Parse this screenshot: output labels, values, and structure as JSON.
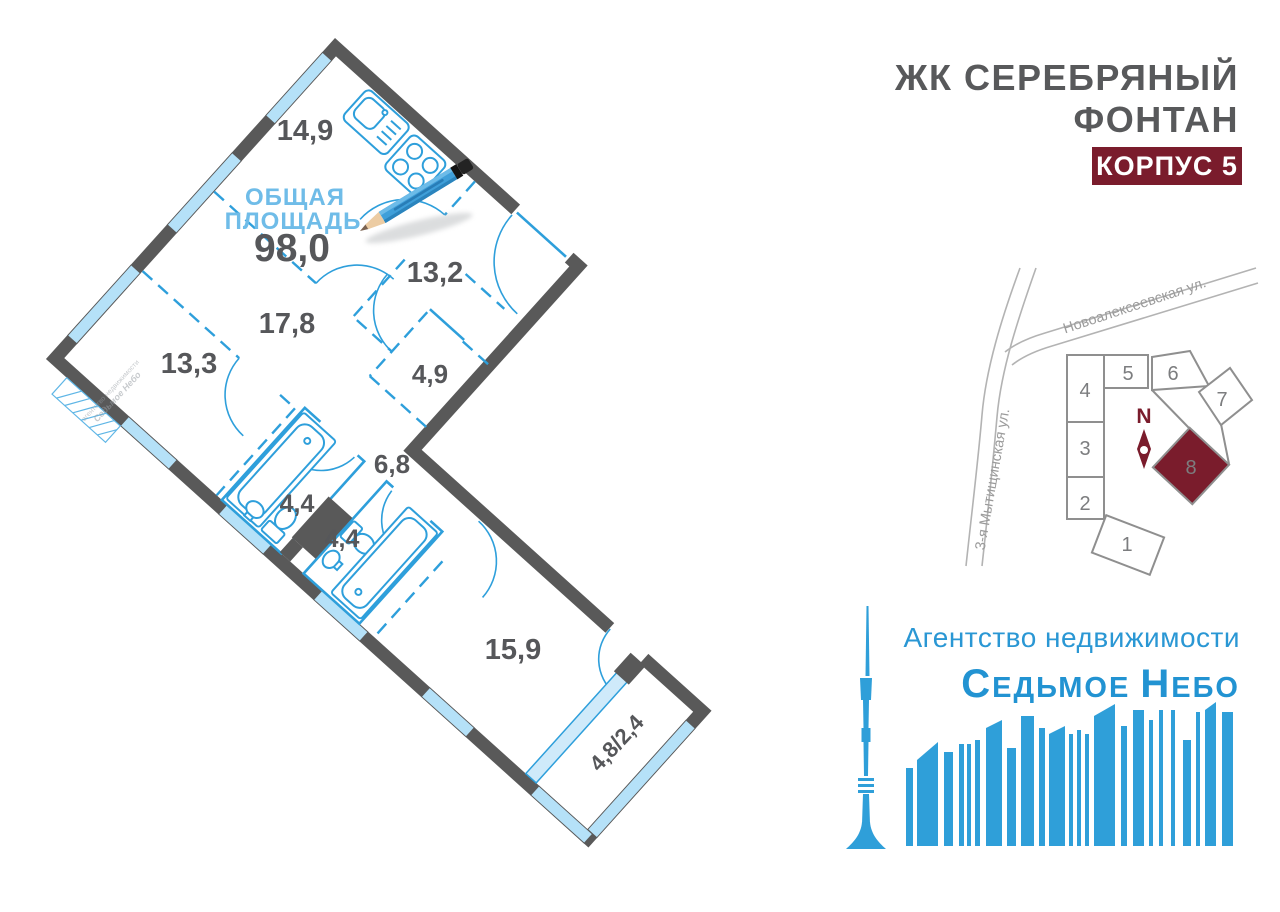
{
  "header": {
    "title_line1": "ЖК СЕРЕБРЯНЫЙ",
    "title_line2": "ФОНТАН",
    "badge": "КОРПУС 5"
  },
  "floorplan": {
    "area_caption_line1": "ОБЩАЯ",
    "area_caption_line2": "ПЛОЩАДЬ",
    "total_area": "98,0",
    "rooms": [
      {
        "name": "kitchen",
        "label": "14,9"
      },
      {
        "name": "hallway",
        "label": "13,2"
      },
      {
        "name": "room-17-8",
        "label": "17,8"
      },
      {
        "name": "room-13-3",
        "label": "13,3"
      },
      {
        "name": "wardrobe",
        "label": "4,9"
      },
      {
        "name": "corridor",
        "label": "6,8"
      },
      {
        "name": "bathroom-1",
        "label": "4,4"
      },
      {
        "name": "bathroom-2",
        "label": "4,4"
      },
      {
        "name": "room-15-9",
        "label": "15,9"
      },
      {
        "name": "balcony",
        "label": "4,8/2,4"
      }
    ],
    "stamp_line1": "агентство недвижимости",
    "stamp_line2": "Седьмое Небо"
  },
  "site_map": {
    "street_top": "Новоалексеевская ул.",
    "street_left": "3-я Мытищинская ул.",
    "compass": "N",
    "buildings": [
      {
        "num": "1"
      },
      {
        "num": "2"
      },
      {
        "num": "3"
      },
      {
        "num": "4"
      },
      {
        "num": "5"
      },
      {
        "num": "6"
      },
      {
        "num": "7"
      },
      {
        "num": "8",
        "highlighted": true
      }
    ]
  },
  "logo": {
    "tagline": "Агентство недвижимости",
    "brand_c1": "С",
    "brand_r1": "ЕДЬМОЕ",
    "brand_c2": "Н",
    "brand_r2": "ЕБО"
  },
  "colors": {
    "wall": "#595959",
    "window": "#b5e1f8",
    "fixture": "#2e9fdb",
    "label": "#56575a",
    "accent": "#7a1c2c",
    "logo_blue": "#2f9fd9"
  }
}
